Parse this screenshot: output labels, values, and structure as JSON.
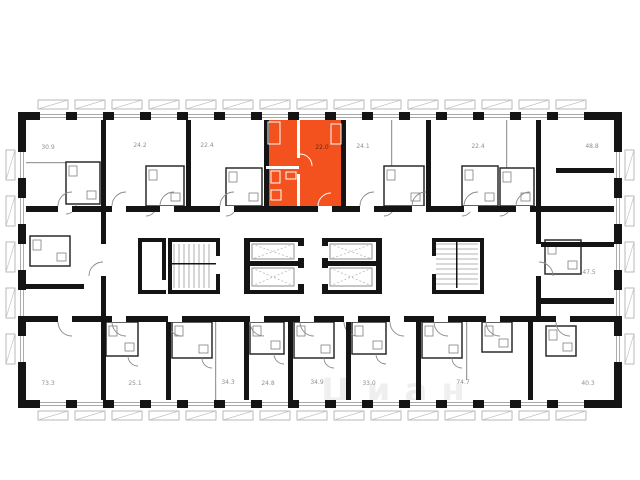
{
  "plan": {
    "wall_color": "#141414",
    "highlight_color": "#F3511D",
    "label_color": "#8f8f8f",
    "highlight_label_color": "#6b2a10",
    "watermark_text": "Циан",
    "highlighted_unit": {
      "area": "22.0",
      "row": "top",
      "position": 4
    },
    "top_units": [
      {
        "area": "30.9"
      },
      {
        "area": "24.2"
      },
      {
        "area": "22.4"
      },
      {
        "area": "22.0"
      },
      {
        "area": "24.1"
      },
      {
        "area": "22.4"
      },
      {
        "area": "48.8"
      }
    ],
    "right_units": [
      {
        "area": "47.5"
      }
    ],
    "bottom_units": [
      {
        "area": "73.3"
      },
      {
        "area": "25.1"
      },
      {
        "area": "34.3"
      },
      {
        "area": "24.8"
      },
      {
        "area": "34.9"
      },
      {
        "area": "33.0"
      },
      {
        "area": "74.7"
      },
      {
        "area": "40.3"
      }
    ],
    "core": {
      "stairwells": 2,
      "elevator_shafts": 4
    }
  }
}
